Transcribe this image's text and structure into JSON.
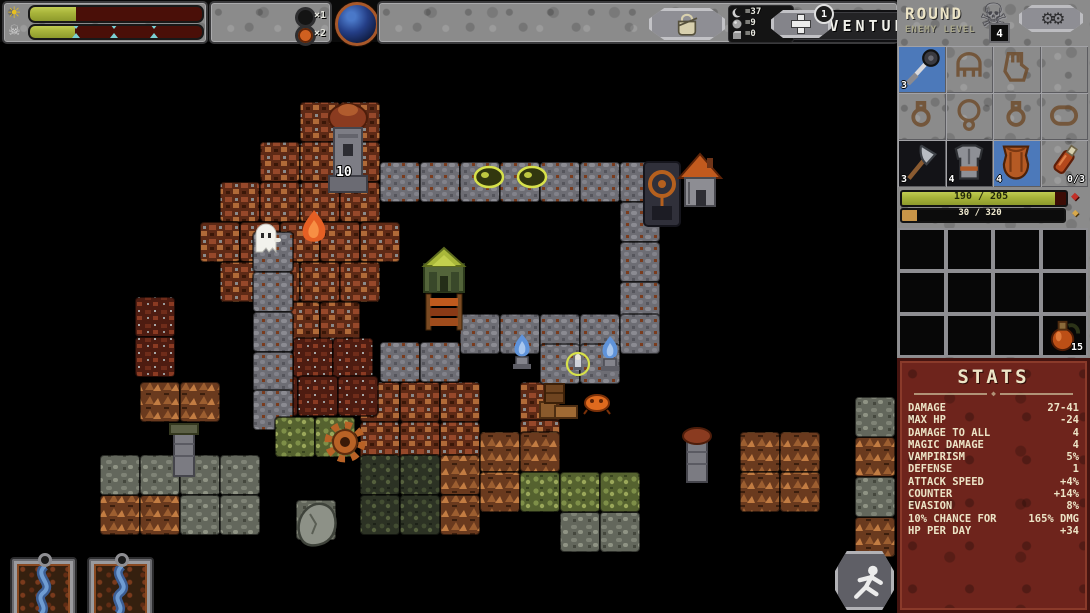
{
  "top_bar": {
    "title": "ADVENTURE",
    "day_bar": {
      "icon": "sun-icon",
      "fill_pct": 27
    },
    "boss_bar": {
      "icon": "skull-icon",
      "fill_pct": 26,
      "markers_pct": [
        27,
        49,
        72
      ]
    },
    "speed": {
      "button_icon": "hourglass-icon",
      "fast_label": "»",
      "x1_label": "×1",
      "x2_label": "×2",
      "active": "x2"
    },
    "world_icon": "planet-orb-icon",
    "inventory_button_icon": "satchel-icon",
    "resources": [
      {
        "icon": "crescent-icon",
        "value": "=37"
      },
      {
        "icon": "orb-icon",
        "value": "=9"
      },
      {
        "icon": "cube-icon",
        "value": "=0"
      }
    ],
    "traits_button_icon": "plus-cross-icon",
    "traits_badge": "1"
  },
  "sidebar": {
    "round_label": "ROUND",
    "enemy_level_label": "ENEMY LEVEL",
    "enemy_level_value": "4",
    "settings_icon": "gears-icon",
    "equipment_slots": [
      {
        "kind": "mace",
        "bg": "blue",
        "count": "3"
      },
      {
        "kind": "helmet",
        "placeholder": true
      },
      {
        "kind": "gauntlet",
        "placeholder": true
      },
      {
        "kind": "empty",
        "placeholder": true
      },
      {
        "kind": "ring",
        "placeholder": true
      },
      {
        "kind": "amulet",
        "placeholder": true
      },
      {
        "kind": "ring",
        "placeholder": true
      },
      {
        "kind": "bracelet",
        "placeholder": true
      },
      {
        "kind": "axe",
        "bg": "dark",
        "count": "3"
      },
      {
        "kind": "armor",
        "bg": "dark",
        "count": "4"
      },
      {
        "kind": "chest",
        "bg": "blue",
        "count": "4"
      },
      {
        "kind": "vial",
        "bg": "none",
        "count": "0/3",
        "count_pos": "right"
      }
    ],
    "hp_bar": {
      "text": "190 / 205",
      "pct": 93,
      "icon": "red-gem-icon"
    },
    "xp_bar": {
      "text": "30 / 320",
      "pct": 9,
      "icon": "gold-diamond-icon"
    },
    "inventory": {
      "rows": 3,
      "cols": 4,
      "potion_cell": 11,
      "potion_count": "15"
    },
    "stats": {
      "title": "STATS",
      "rows": [
        {
          "label": "DAMAGE",
          "value": "27-41"
        },
        {
          "label": "MAX HP",
          "value": "-24"
        },
        {
          "label": "DAMAGE TO ALL",
          "value": "4"
        },
        {
          "label": "MAGIC DAMAGE",
          "value": "4"
        },
        {
          "label": "VAMPIRISM",
          "value": "5%"
        },
        {
          "label": "DEFENSE",
          "value": "1"
        },
        {
          "label": "ATTACK SPEED",
          "value": "+4%"
        },
        {
          "label": "COUNTER",
          "value": "+14%"
        },
        {
          "label": "EVASION",
          "value": "8%"
        },
        {
          "label": "10% CHANCE FOR",
          "value": "165% DMG"
        },
        {
          "label": "HP PER DAY",
          "value": "+34"
        }
      ]
    }
  },
  "cards": [
    {
      "art": "river-card"
    },
    {
      "art": "river-card"
    }
  ],
  "retreat_icon": "running-figure-icon",
  "map": {
    "tile_size": 40,
    "order": [
      "v",
      "c",
      "p",
      "m",
      "r",
      "t",
      "b"
    ],
    "tiles": {
      "v": [
        [
          300,
          60
        ],
        [
          340,
          60
        ],
        [
          260,
          100
        ],
        [
          300,
          100
        ],
        [
          340,
          100
        ],
        [
          220,
          140
        ],
        [
          260,
          140
        ],
        [
          300,
          140
        ],
        [
          340,
          140
        ],
        [
          200,
          180
        ],
        [
          240,
          180
        ],
        [
          280,
          180
        ],
        [
          320,
          180
        ],
        [
          360,
          180
        ],
        [
          220,
          220
        ],
        [
          260,
          220
        ],
        [
          300,
          220
        ],
        [
          340,
          220
        ],
        [
          280,
          260
        ],
        [
          320,
          260
        ],
        [
          360,
          340
        ],
        [
          400,
          340
        ],
        [
          440,
          340
        ],
        [
          360,
          380
        ],
        [
          400,
          380
        ],
        [
          440,
          380
        ],
        [
          520,
          340
        ],
        [
          520,
          378
        ]
      ],
      "c": [
        [
          135,
          255
        ],
        [
          135,
          295
        ],
        [
          293,
          296
        ],
        [
          333,
          296
        ],
        [
          258,
          334
        ],
        [
          298,
          334
        ],
        [
          338,
          334
        ]
      ],
      "p": [
        [
          380,
          120
        ],
        [
          420,
          120
        ],
        [
          460,
          120
        ],
        [
          500,
          120
        ],
        [
          540,
          120
        ],
        [
          580,
          120
        ],
        [
          620,
          120
        ],
        [
          620,
          160
        ],
        [
          620,
          200
        ],
        [
          620,
          240
        ],
        [
          460,
          272
        ],
        [
          500,
          272
        ],
        [
          540,
          272
        ],
        [
          580,
          272
        ],
        [
          620,
          272
        ],
        [
          380,
          300
        ],
        [
          420,
          300
        ],
        [
          540,
          302
        ],
        [
          580,
          302
        ],
        [
          253,
          190
        ],
        [
          253,
          230
        ],
        [
          253,
          270
        ],
        [
          253,
          310
        ],
        [
          253,
          348
        ]
      ],
      "m": [
        [
          140,
          340
        ],
        [
          180,
          340
        ],
        [
          100,
          453
        ],
        [
          140,
          453
        ],
        [
          440,
          413
        ],
        [
          440,
          453
        ],
        [
          480,
          390
        ],
        [
          520,
          390
        ],
        [
          480,
          430
        ],
        [
          740,
          390
        ],
        [
          780,
          390
        ],
        [
          740,
          430
        ],
        [
          780,
          430
        ],
        [
          855,
          395
        ],
        [
          855,
          475
        ]
      ],
      "r": [
        [
          100,
          413
        ],
        [
          140,
          413
        ],
        [
          180,
          413
        ],
        [
          220,
          413
        ],
        [
          180,
          453
        ],
        [
          220,
          453
        ],
        [
          560,
          470
        ],
        [
          600,
          470
        ],
        [
          855,
          355
        ],
        [
          855,
          435
        ],
        [
          296,
          458
        ]
      ],
      "t": [
        [
          360,
          413
        ],
        [
          400,
          413
        ],
        [
          360,
          453
        ],
        [
          400,
          453
        ]
      ],
      "b": [
        [
          275,
          375
        ],
        [
          315,
          375
        ],
        [
          520,
          430
        ],
        [
          560,
          430
        ],
        [
          600,
          430
        ]
      ]
    },
    "sprites": [
      {
        "t": "tower",
        "x": 326,
        "y": 58
      },
      {
        "t": "gate",
        "x": 644,
        "y": 118
      },
      {
        "t": "house",
        "x": 679,
        "y": 108
      },
      {
        "t": "grove",
        "x": 421,
        "y": 204
      },
      {
        "t": "banner",
        "x": 425,
        "y": 252
      },
      {
        "t": "ghost",
        "x": 254,
        "y": 180
      },
      {
        "t": "oflame",
        "x": 301,
        "y": 168
      },
      {
        "t": "slime",
        "x": 474,
        "y": 124
      },
      {
        "t": "slime",
        "x": 517,
        "y": 124
      },
      {
        "t": "bflame",
        "x": 512,
        "y": 292
      },
      {
        "t": "bflame",
        "x": 600,
        "y": 294
      },
      {
        "t": "heroring",
        "x": 566,
        "y": 310
      },
      {
        "t": "creature",
        "x": 584,
        "y": 352
      },
      {
        "t": "crates",
        "x": 540,
        "y": 340
      },
      {
        "t": "gearwheel",
        "x": 325,
        "y": 380
      },
      {
        "t": "wtowerL",
        "x": 165,
        "y": 376
      },
      {
        "t": "wtowerR",
        "x": 678,
        "y": 382
      },
      {
        "t": "boulder",
        "x": 296,
        "y": 458
      }
    ],
    "labels": [
      {
        "text": "10",
        "x": 336,
        "y": 134
      }
    ]
  }
}
